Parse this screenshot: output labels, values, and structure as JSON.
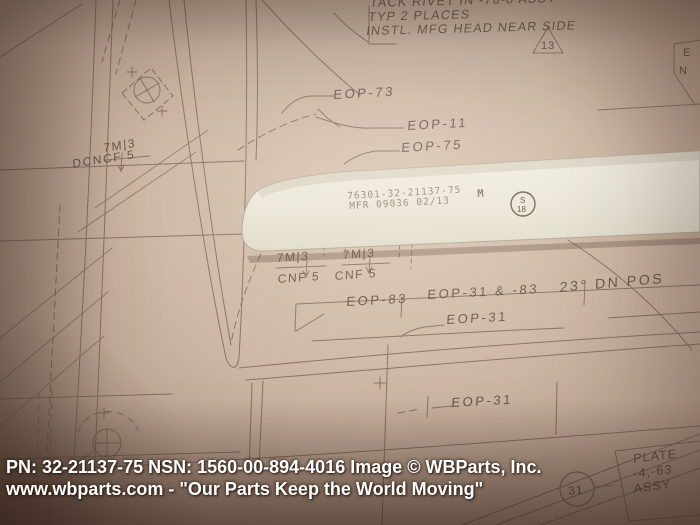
{
  "photo": {
    "alt": "White aircraft strip part lying diagonally on a tan engineering drawing, product photo",
    "colors": {
      "paper": "#cdb6a4",
      "ink": "#6f5a4b",
      "part": "#eae7da",
      "caption_text": "#ffffff"
    }
  },
  "caption": {
    "line1": "PN: 32-21137-75  NSN: 1560-00-894-4016 Image © WBParts, Inc.",
    "line2": "www.wbparts.com - \"Our Parts Keep the World Moving\""
  },
  "part": {
    "part_number": "76301-32-21137-75",
    "suffix": "M",
    "mfr_line": "MFR 09036 02/13",
    "stamp": {
      "top": "S",
      "bottom": "18"
    }
  },
  "drawing": {
    "note_lines": [
      "TACK RIVET IN -76-8 ASSY",
      "TYP 2 PLACES",
      "INSTL. MFG HEAD NEAR SIDE"
    ],
    "flag_triangle": "13",
    "corner_letters": {
      "e": "E",
      "n": "N"
    },
    "labels": {
      "eop_73": "EOP-73",
      "eop_11": "EOP-11",
      "eop_75": "EOP-75",
      "flag_7m3_left": "7M|3",
      "dcncf_5": "DCNCF 5",
      "flag_7m3_a": "7M|3",
      "cnf_5_a": "CNF 5",
      "flag_7m3_b": "7M|3",
      "cnf_5_b": "CNF 5",
      "eop_83": "EOP-83",
      "eop_31_83": "EOP-31 & -83",
      "angle_note": "23° DN POS",
      "eop_31_mid": "EOP-31",
      "eop_31_bottom": "EOP-31",
      "balloon": "31",
      "plate_line1": "PLATE",
      "plate_line2": "-4,-63",
      "plate_line3": "ASSY"
    }
  }
}
